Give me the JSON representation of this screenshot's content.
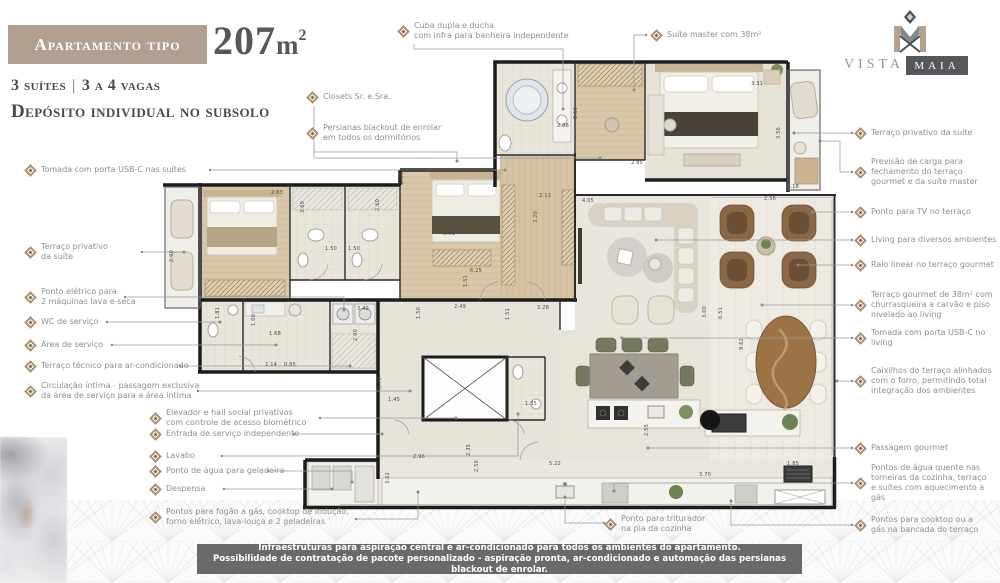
{
  "header": {
    "badge": "Apartamento tipo",
    "area_number": "207",
    "area_unit": "m",
    "area_sup": "2",
    "subtitle1_a": "3 suítes",
    "subtitle1_sep": "|",
    "subtitle1_b": "3 a 4 vagas",
    "subtitle2": "Depósito individual no subsolo"
  },
  "logo": {
    "word1": "VISTA",
    "word2": "MAIA"
  },
  "callouts": {
    "top": [
      {
        "text": "Cuba dupla e ducha\ncom infra para banheira independente"
      },
      {
        "text": "Suíte master com 38m²"
      },
      {
        "text": "Closets Sr. e Sra."
      },
      {
        "text": "Persianas blackout de enrolar\nem todos os dormitórios"
      }
    ],
    "left": [
      {
        "text": "Tomada com porta USB-C nas suítes"
      },
      {
        "text": "Terraço privativo\nda suíte"
      },
      {
        "text": "Ponto elétrico para\n2 máquinas lava e seca"
      },
      {
        "text": "WC de serviço"
      },
      {
        "text": "Área de serviço"
      },
      {
        "text": "Terraço técnico para ar-condicionado"
      },
      {
        "text": "Circulação íntima - passagem exclusiva\nda área de serviço para a área íntima"
      },
      {
        "text": "Elevador e hall social privativos\ncom controle de acesso biométrico"
      },
      {
        "text": "Entrada de serviço independente"
      },
      {
        "text": "Lavabo"
      },
      {
        "text": "Ponto de água para geladeira"
      },
      {
        "text": "Despensa"
      },
      {
        "text": "Pontos para fogão a gás, cooktop de indução,\nforno elétrico, lava-louça e 2 geladeiras"
      }
    ],
    "right": [
      {
        "text": "Terraço privativo da suíte"
      },
      {
        "text": "Previsão de carga para\nfechamento do terraço\ngourmet e da suíte master"
      },
      {
        "text": "Ponto para TV no terraço"
      },
      {
        "text": "Living para diversos ambientes"
      },
      {
        "text": "Ralo linear no terraço gourmet"
      },
      {
        "text": "Terraço gourmet de 38m² com\nchurrasqueira a carvão e piso\nnivelado ao living"
      },
      {
        "text": "Tomada com porta USB-C no living"
      },
      {
        "text": "Caixilhos do terraço alinhados\ncom o forro, permitindo total\nintegração dos ambientes"
      },
      {
        "text": "Passagem gourmet"
      },
      {
        "text": "Pontos de água quente nas\ntorneiras da cozinha, terraço\ne suítes com aquecimento a gás"
      },
      {
        "text": "Pontos para cooktop ou a\ngás na bancada do terraço"
      }
    ],
    "bottom": [
      {
        "text": "Ponto para triturador\nna pia da cozinha"
      }
    ]
  },
  "footer": {
    "line1": "Infraestruturas para aspiração central e ar-condicionado para todos os ambientes do apartamento.",
    "line2": "Possibilidade de contratação de pacote personalizado - aspiração pronta, ar-condicionado e automação das persianas blackout de enrolar."
  },
  "plan": {
    "dimensions": [
      {
        "x": 563,
        "y": 126,
        "label": "2.86"
      },
      {
        "x": 576,
        "y": 113,
        "label": "2.50",
        "v": 1
      },
      {
        "x": 637,
        "y": 163,
        "label": "2.85"
      },
      {
        "x": 757,
        "y": 84,
        "label": "3.31"
      },
      {
        "x": 779,
        "y": 133,
        "label": "3.56",
        "v": 1
      },
      {
        "x": 793,
        "y": 187,
        "label": "1.18"
      },
      {
        "x": 770,
        "y": 199,
        "label": "2.56"
      },
      {
        "x": 277,
        "y": 193,
        "label": "2.63"
      },
      {
        "x": 303,
        "y": 207,
        "label": "3.60",
        "v": 1
      },
      {
        "x": 378,
        "y": 205,
        "label": "2.60",
        "v": 1
      },
      {
        "x": 331,
        "y": 249,
        "label": "1.50"
      },
      {
        "x": 354,
        "y": 249,
        "label": "1.50"
      },
      {
        "x": 402,
        "y": 178,
        "label": "2.95",
        "v": 1
      },
      {
        "x": 449,
        "y": 234,
        "label": "3.91"
      },
      {
        "x": 476,
        "y": 271,
        "label": "6.25"
      },
      {
        "x": 466,
        "y": 281,
        "label": "1.51",
        "v": 1
      },
      {
        "x": 172,
        "y": 256,
        "label": "2.90",
        "v": 1
      },
      {
        "x": 545,
        "y": 196,
        "label": "2.13"
      },
      {
        "x": 588,
        "y": 201,
        "label": "4.05"
      },
      {
        "x": 536,
        "y": 217,
        "label": "3.20",
        "v": 1
      },
      {
        "x": 543,
        "y": 308,
        "label": "3.28"
      },
      {
        "x": 363,
        "y": 309,
        "label": "3.42"
      },
      {
        "x": 460,
        "y": 307,
        "label": "2.49"
      },
      {
        "x": 419,
        "y": 313,
        "label": "1.50",
        "v": 1
      },
      {
        "x": 508,
        "y": 314,
        "label": "1.51",
        "v": 1
      },
      {
        "x": 218,
        "y": 313,
        "label": "1.81",
        "v": 1
      },
      {
        "x": 254,
        "y": 320,
        "label": "1.00",
        "v": 1
      },
      {
        "x": 275,
        "y": 334,
        "label": "1.68"
      },
      {
        "x": 356,
        "y": 335,
        "label": "2.00",
        "v": 1
      },
      {
        "x": 271,
        "y": 365,
        "label": "2.14"
      },
      {
        "x": 290,
        "y": 365,
        "label": "0.85"
      },
      {
        "x": 380,
        "y": 383,
        "label": "5.79",
        "v": 1
      },
      {
        "x": 394,
        "y": 400,
        "label": "1.45"
      },
      {
        "x": 531,
        "y": 404,
        "label": "1.35"
      },
      {
        "x": 419,
        "y": 457,
        "label": "2.96"
      },
      {
        "x": 469,
        "y": 450,
        "label": "2.35",
        "v": 1
      },
      {
        "x": 477,
        "y": 466,
        "label": "2.50",
        "v": 1
      },
      {
        "x": 388,
        "y": 478,
        "label": "3.62",
        "v": 1
      },
      {
        "x": 705,
        "y": 312,
        "label": "3.00",
        "v": 1
      },
      {
        "x": 721,
        "y": 313,
        "label": "6.51",
        "v": 1
      },
      {
        "x": 742,
        "y": 344,
        "label": "9.62",
        "v": 1
      },
      {
        "x": 555,
        "y": 464,
        "label": "5.22"
      },
      {
        "x": 705,
        "y": 475,
        "label": "3.70"
      },
      {
        "x": 793,
        "y": 464,
        "label": "1.85"
      },
      {
        "x": 647,
        "y": 430,
        "label": "2.55",
        "v": 1
      }
    ]
  }
}
